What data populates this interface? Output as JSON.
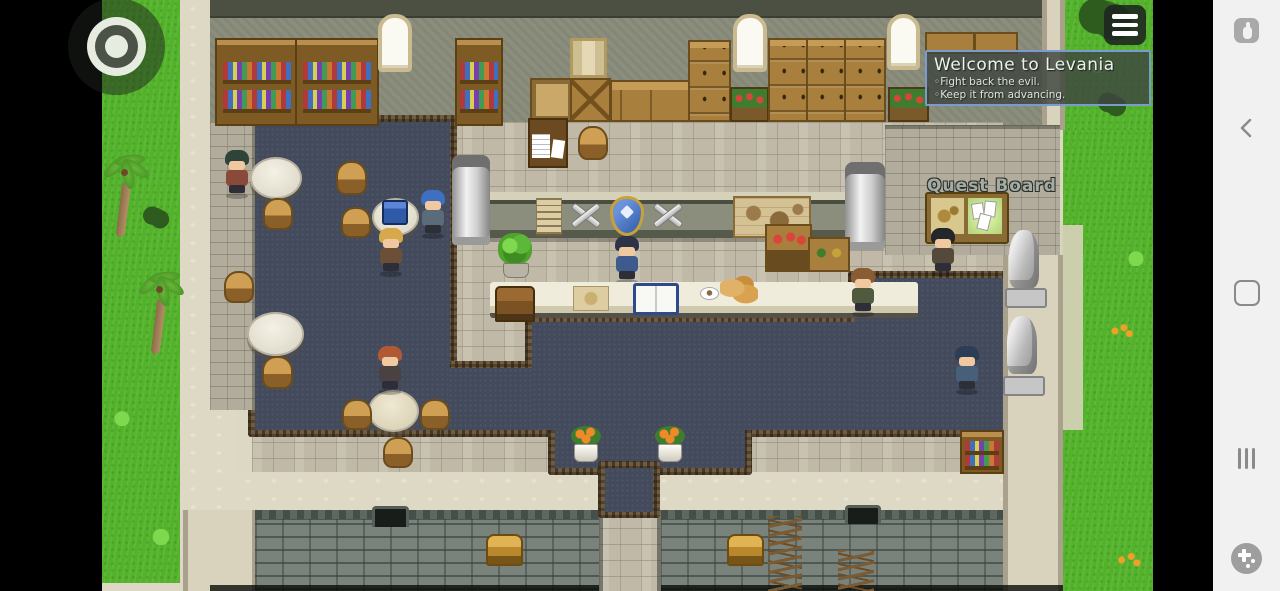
{
  "game_screen": {
    "message_popup": {
      "title": "Welcome to Levania",
      "lines": [
        "◦Fight back the evil.",
        "◦Keep it from advancing."
      ],
      "border_color": "#7b9bce",
      "background_color": "rgba(62,70,64,0.82)"
    },
    "map_labels": {
      "quest_board": "Quest Board"
    },
    "hud": {
      "menu_icon": "hamburger-menu-icon",
      "joystick_icon": "virtual-joystick"
    },
    "palette": {
      "grass": "#52b22a",
      "carpet": "#424a5c",
      "carpet_border": "#6f5c40",
      "floor_tile": "#c8c2b1",
      "floor_light": "#ded9c4",
      "wall_top": "#8b8e7c",
      "wall_brick": "#79837c",
      "wood": "#a87f3c",
      "counter": "#eae6d3",
      "letterbox": "#000000"
    }
  },
  "system_bar": {
    "background": "#f1f1f1",
    "icon_color": "#8a8a8a",
    "icons": {
      "touch_mode": "touch-pointer-icon",
      "back": "back-chevron-icon",
      "home": "home-circle-icon",
      "recents": "recents-bars-icon",
      "gamepad": "gamepad-toggle-icon"
    }
  }
}
